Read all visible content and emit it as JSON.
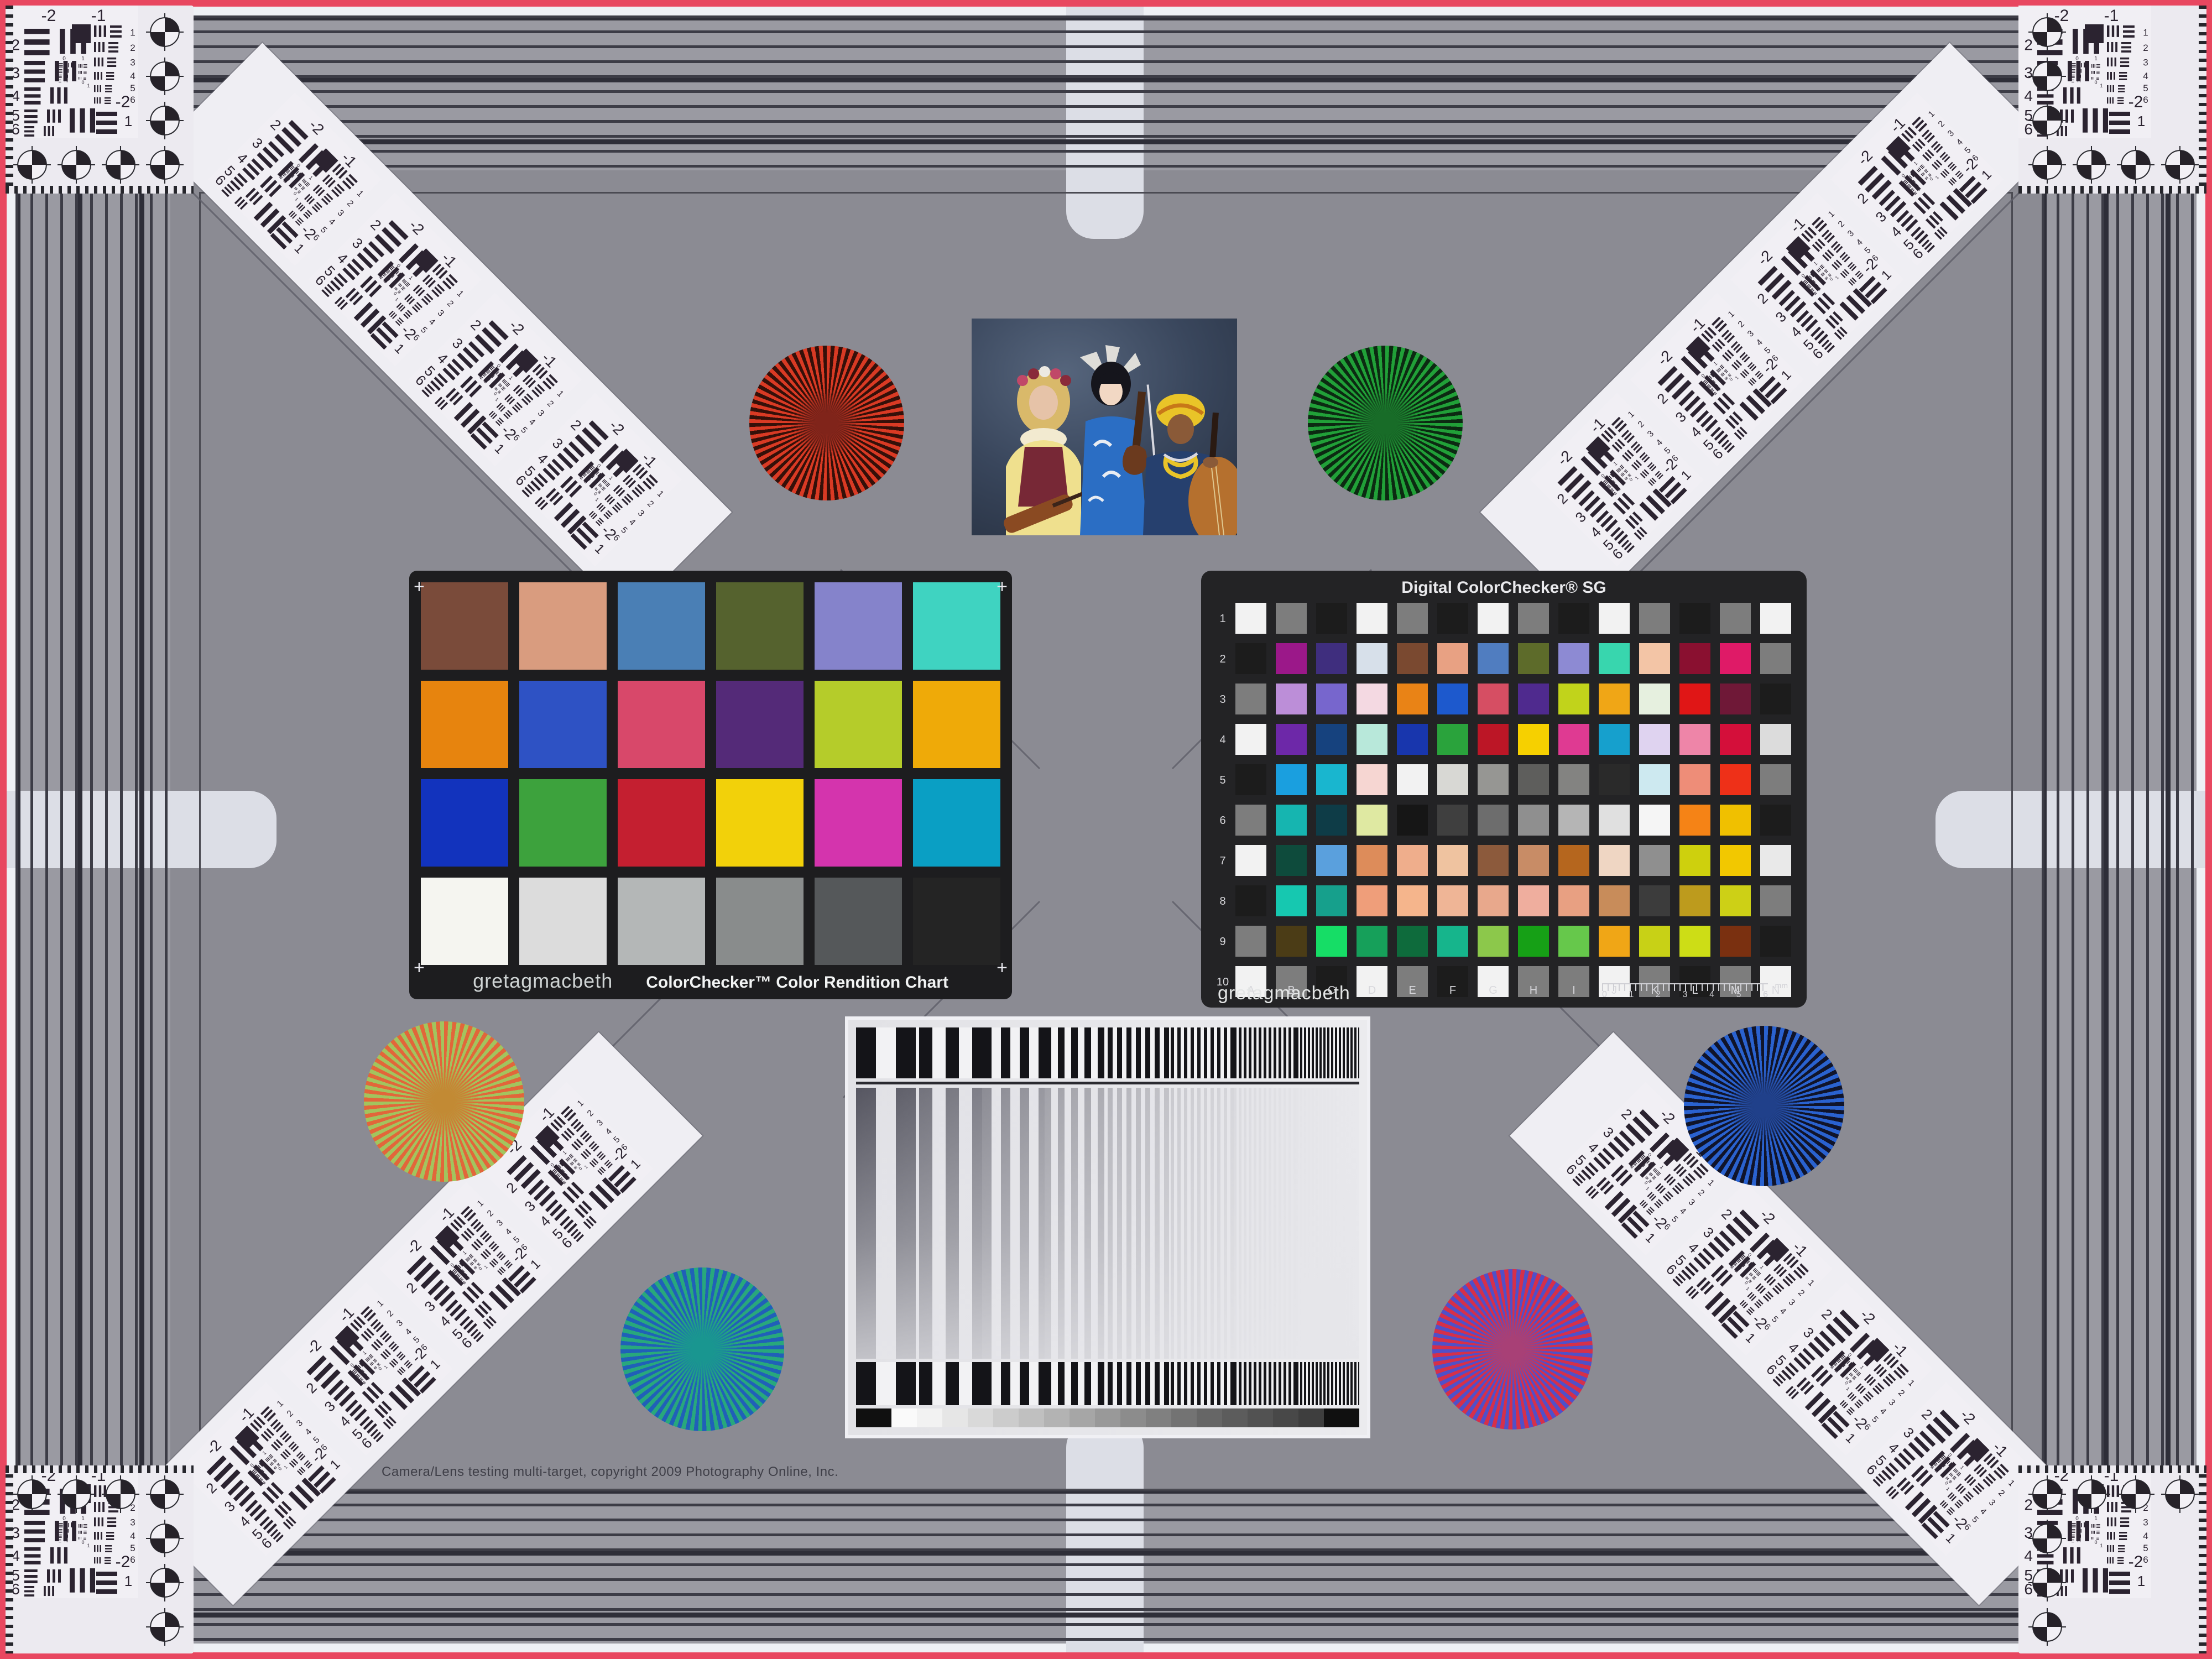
{
  "frame": {
    "field_color": "#8b8b93",
    "band_color": "#9a9aa2",
    "stripe_dark": "#3c3c46",
    "edge_red": "#e84760",
    "margin_white": "#eef0f5",
    "marker_light": "#dcdee6"
  },
  "usaf": {
    "top_left_label": "-2",
    "top_right_label": "-1",
    "left_rows": [
      "2",
      "3",
      "4",
      "5",
      "6"
    ],
    "right_rows": [
      "1",
      "2",
      "3",
      "4",
      "5",
      "6"
    ],
    "bottom_label": "-2",
    "bottom_sub_label": "1",
    "mini_labels": [
      "0",
      "1"
    ]
  },
  "colorchecker": {
    "brand": "gretagmacbeth",
    "title": "ColorChecker™ Color Rendition Chart",
    "corner_mark": "+",
    "rows": [
      [
        "#7a4b3a",
        "#d99c7f",
        "#4a7fb5",
        "#55622e",
        "#8583cb",
        "#3fd3c1"
      ],
      [
        "#e7840e",
        "#2e52c4",
        "#d8486a",
        "#542a78",
        "#b5cc2a",
        "#efaa08"
      ],
      [
        "#1233bd",
        "#3da23d",
        "#c41f30",
        "#f2d10a",
        "#d434ad",
        "#0a9fc4"
      ],
      [
        "#f5f5f0",
        "#dcdcdc",
        "#b4b7b7",
        "#898c8c",
        "#55585a",
        "#242424"
      ]
    ]
  },
  "sg": {
    "title": "Digital ColorChecker® SG",
    "brand": "gretagmacbeth",
    "row_labels": [
      "1",
      "2",
      "3",
      "4",
      "5",
      "6",
      "7",
      "8",
      "9",
      "10"
    ],
    "col_labels": [
      "A",
      "B",
      "C",
      "D",
      "E",
      "F",
      "G",
      "H",
      "I",
      "J",
      "K",
      "L",
      "M",
      "N"
    ],
    "ruler": {
      "numbers": [
        "0",
        "1",
        "2",
        "3",
        "4",
        "5",
        "6"
      ],
      "unit": "mm"
    },
    "rows": [
      [
        "#f2f2f2",
        "#7d7d7d",
        "#1c1c1c",
        "#f2f2f2",
        "#7d7d7d",
        "#1c1c1c",
        "#f2f2f2",
        "#7d7d7d",
        "#1c1c1c",
        "#f2f2f2",
        "#7d7d7d",
        "#1c1c1c",
        "#7d7d7d",
        "#f2f2f2"
      ],
      [
        "#1c1c1c",
        "#9b1889",
        "#3f2e7e",
        "#d7e0ea",
        "#7a4930",
        "#e8a183",
        "#507dc0",
        "#5d6b2a",
        "#8d8ad3",
        "#38d6ae",
        "#f3c5a6",
        "#8a1030",
        "#df1a67",
        "#7d7d7d"
      ],
      [
        "#7d7d7d",
        "#bc8ed8",
        "#7766cd",
        "#f4d9e2",
        "#e98316",
        "#1d59cd",
        "#d64e63",
        "#4f2a8e",
        "#c1d31b",
        "#f0a616",
        "#e6f0df",
        "#e01616",
        "#6f1837",
        "#1c1c1c"
      ],
      [
        "#f2f2f2",
        "#6d28a8",
        "#16427e",
        "#b8e8da",
        "#1836ad",
        "#2aa33c",
        "#bc1626",
        "#f6d000",
        "#df3a92",
        "#16a0cd",
        "#dfd3f0",
        "#ee85a8",
        "#d40f3a",
        "#dcdcdc"
      ],
      [
        "#1c1c1c",
        "#1a9fdf",
        "#19b6cf",
        "#f6d6d2",
        "#f2f2f2",
        "#d8d8d4",
        "#969693",
        "#5e5e5c",
        "#838381",
        "#2a2a2a",
        "#cde9f0",
        "#ee8d78",
        "#ee3018",
        "#7d7d7d"
      ],
      [
        "#7d7d7d",
        "#16b5b0",
        "#0e3c47",
        "#dfe9a2",
        "#161616",
        "#3f3f3f",
        "#6d6d6d",
        "#8f8f8f",
        "#b5b5b5",
        "#e0e0e0",
        "#f5f5f5",
        "#f58316",
        "#f0c000",
        "#1c1c1c"
      ],
      [
        "#f2f2f2",
        "#0e4b3c",
        "#5aa0dd",
        "#dd8c5a",
        "#efae8c",
        "#efc3a0",
        "#8c5a3c",
        "#c88c66",
        "#b5661e",
        "#efd6c3",
        "#8f8f8f",
        "#ced00d",
        "#f2c800",
        "#e9e9e9"
      ],
      [
        "#1c1c1c",
        "#16c8b0",
        "#16a08c",
        "#ef9e7a",
        "#f5b58c",
        "#efb596",
        "#e8a88c",
        "#efae9e",
        "#e8a082",
        "#c88c5a",
        "#3c3c3c",
        "#bd9b1d",
        "#cdd016",
        "#7d7d7d"
      ],
      [
        "#7d7d7d",
        "#4b3c16",
        "#16dd66",
        "#16a05a",
        "#0e6b3c",
        "#16b58c",
        "#8cc84b",
        "#16a016",
        "#66c84b",
        "#f0a616",
        "#c8d116",
        "#cddd16",
        "#7a3010",
        "#1c1c1c"
      ],
      [
        "#f2f2f2",
        "#7d7d7d",
        "#1c1c1c",
        "#f2f2f2",
        "#7d7d7d",
        "#1c1c1c",
        "#f2f2f2",
        "#7d7d7d",
        "#7d7d7d",
        "#f2f2f2",
        "#7d7d7d",
        "#1c1c1c",
        "#7d7d7d",
        "#f2f2f2"
      ]
    ]
  },
  "stars": [
    {
      "id": "red",
      "color_a": "#d93a24",
      "color_b": "#351009",
      "blend": "#80241a"
    },
    {
      "id": "green",
      "color_a": "#21a038",
      "color_b": "#0c2a12",
      "blend": "#186c28"
    },
    {
      "id": "amber",
      "color_a": "#e2663a",
      "color_b": "#a2c45e",
      "blend": "#c28a34"
    },
    {
      "id": "blue",
      "color_a": "#2a62cf",
      "color_b": "#10142a",
      "blend": "#20408a"
    },
    {
      "id": "teal",
      "color_a": "#28a87c",
      "color_b": "#2060b8",
      "blend": "#199690"
    },
    {
      "id": "magenta",
      "color_a": "#d5304a",
      "color_b": "#5050c8",
      "blend": "#a84076"
    }
  ],
  "sweep": {
    "periods": [
      72,
      48,
      34,
      24,
      17,
      12,
      9,
      7
    ],
    "bar_dark": "#141418",
    "bar_light": "#f2f2f4",
    "wedge": [
      "#101010",
      "#fafafa",
      "#f2f2f2",
      "#e6e6e6",
      "#d9d9d9",
      "#cccccc",
      "#c0c0c0",
      "#b3b3b3",
      "#a6a6a6",
      "#999999",
      "#8c8c8c",
      "#808080",
      "#737373",
      "#666666",
      "#5c5c5c",
      "#525252",
      "#484848",
      "#3e3e3e",
      "#101010"
    ]
  },
  "photo": {
    "subject": "three-musicians-with-violins-and-cello",
    "palette": {
      "backdrop": "#39465c",
      "backdrop_light": "#56657c",
      "skin_fair": "#e6c3a8",
      "skin_medium": "#f2d8c4",
      "skin_dark": "#8a5a38",
      "hair_blonde": "#d9b96a",
      "hair_black": "#15151c",
      "dress_yellow": "#efe08e",
      "vest_maroon": "#772836",
      "kimono_blue": "#2b6ec4",
      "robe_navy": "#26406e",
      "turban_yellow": "#e9c428",
      "violin_brown": "#8a4a22",
      "cello_orange": "#b5702e",
      "flower_pink": "#c04868",
      "white": "#ece9e2"
    }
  },
  "copyright_line": "Camera/Lens testing multi-target, copyright 2009 Photography Online, Inc."
}
